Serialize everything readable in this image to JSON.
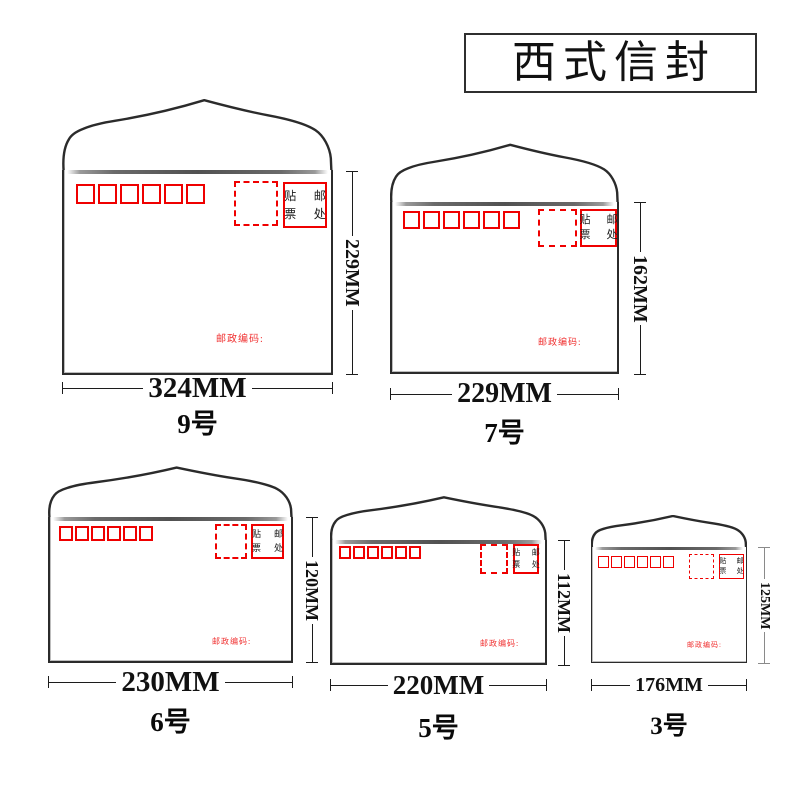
{
  "header": {
    "title": "西式信封"
  },
  "labels": {
    "stamp_row1": "贴 邮",
    "stamp_row2": "票 处",
    "postal_caption": "邮政编码:"
  },
  "colors": {
    "accent_red": "#ef0000",
    "line_black": "#2b2b2b"
  },
  "envelopes": [
    {
      "name": "9号",
      "width": "324MM",
      "height": "229MM"
    },
    {
      "name": "7号",
      "width": "229MM",
      "height": "162MM"
    },
    {
      "name": "6号",
      "width": "230MM",
      "height": "120MM"
    },
    {
      "name": "5号",
      "width": "220MM",
      "height": "112MM"
    },
    {
      "name": "3号",
      "width": "176MM",
      "height": "125MM"
    }
  ]
}
